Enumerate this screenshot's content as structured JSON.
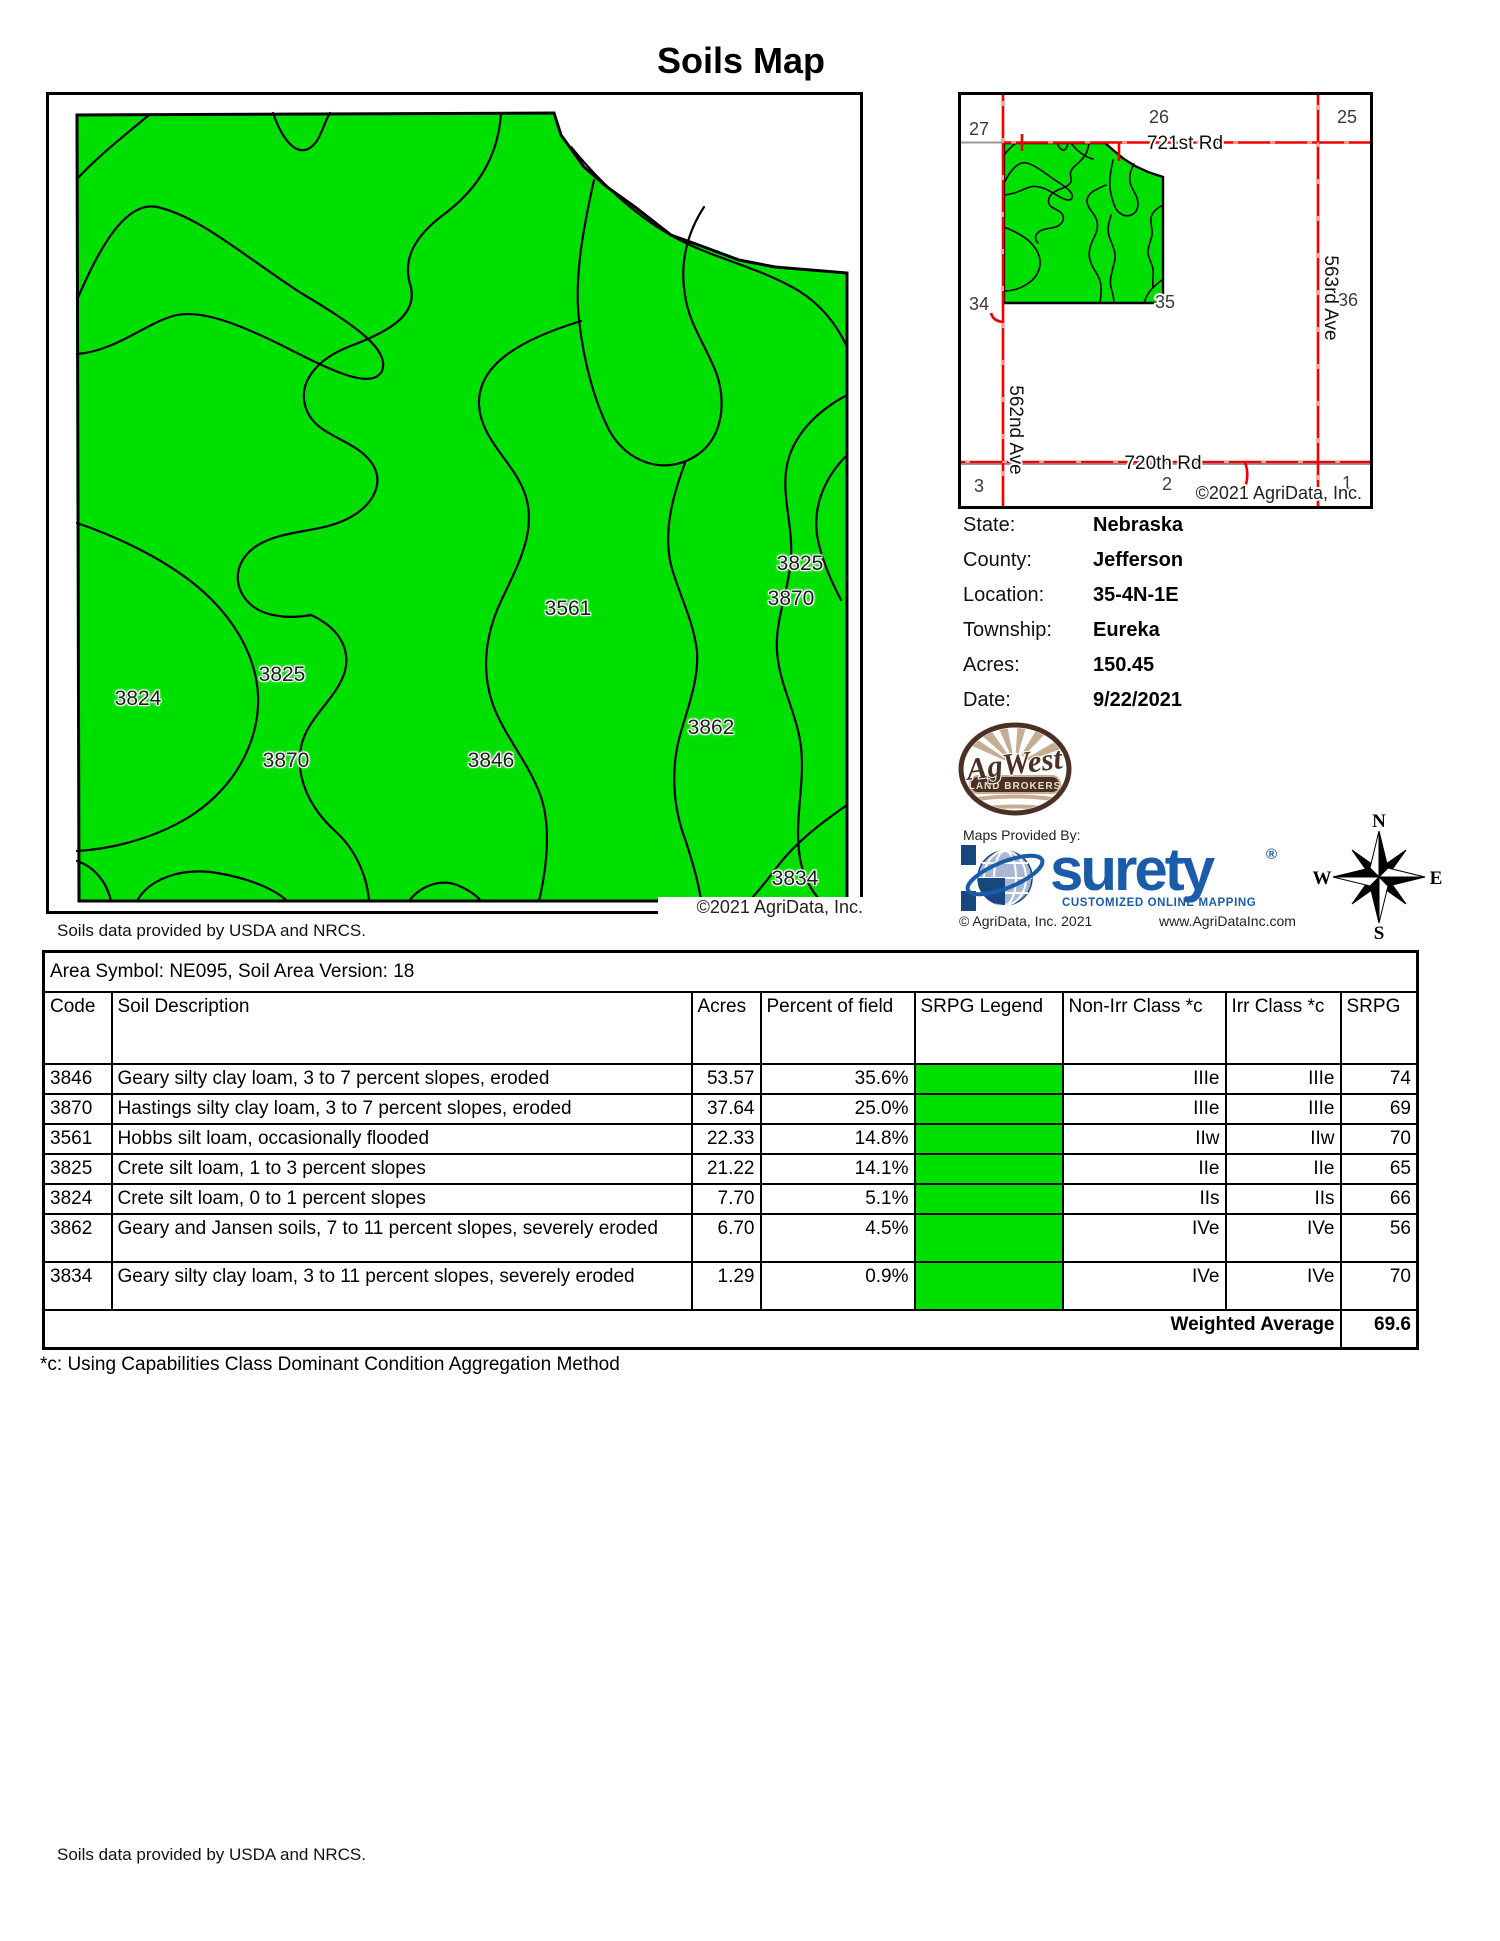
{
  "title": "Soils Map",
  "main_map": {
    "labels": [
      "3825",
      "3870",
      "3561",
      "3825",
      "3824",
      "3862",
      "3870",
      "3846",
      "3834"
    ],
    "copyright": "©2021 AgriData, Inc.",
    "attribution": "Soils data provided by USDA and NRCS."
  },
  "locator": {
    "sections": [
      "27",
      "26",
      "25",
      "34",
      "35",
      "36",
      "3",
      "2",
      "1"
    ],
    "roads": {
      "r721": "721st Rd",
      "r720": "720th Rd",
      "a562": "562nd Ave",
      "a563": "563rd Ave"
    },
    "copyright": "©2021 AgriData, Inc."
  },
  "info": {
    "rows": [
      {
        "label": "State:",
        "value": "Nebraska"
      },
      {
        "label": "County:",
        "value": "Jefferson"
      },
      {
        "label": "Location:",
        "value": "35-4N-1E"
      },
      {
        "label": "Township:",
        "value": "Eureka"
      },
      {
        "label": "Acres:",
        "value": "150.45"
      },
      {
        "label": "Date:",
        "value": "9/22/2021"
      }
    ]
  },
  "logos": {
    "agwest": {
      "name": "AgWest",
      "banner": "LAND BROKERS"
    },
    "surety": {
      "provided_by": "Maps Provided By:",
      "brand": "surety",
      "reg": "®",
      "tagline": "CUSTOMIZED ONLINE MAPPING",
      "copyright": "© AgriData, Inc. 2021",
      "website": "www.AgriDataInc.com"
    }
  },
  "compass": {
    "n": "N",
    "s": "S",
    "e": "E",
    "w": "W"
  },
  "table": {
    "area_symbol": "Area Symbol: NE095, Soil Area Version: 18",
    "headers": [
      "Code",
      "Soil Description",
      "Acres",
      "Percent of field",
      "SRPG Legend",
      "Non-Irr Class *c",
      "Irr Class *c",
      "SRPG"
    ],
    "rows": [
      {
        "code": "3846",
        "description": "Geary silty clay loam, 3 to 7 percent slopes, eroded",
        "acres": "53.57",
        "percent": "35.6%",
        "non_irr": "IIIe",
        "irr": "IIIe",
        "srpg": "74"
      },
      {
        "code": "3870",
        "description": "Hastings silty clay loam, 3 to 7 percent slopes, eroded",
        "acres": "37.64",
        "percent": "25.0%",
        "non_irr": "IIIe",
        "irr": "IIIe",
        "srpg": "69"
      },
      {
        "code": "3561",
        "description": "Hobbs silt loam, occasionally flooded",
        "acres": "22.33",
        "percent": "14.8%",
        "non_irr": "IIw",
        "irr": "IIw",
        "srpg": "70"
      },
      {
        "code": "3825",
        "description": "Crete silt loam, 1 to 3 percent slopes",
        "acres": "21.22",
        "percent": "14.1%",
        "non_irr": "IIe",
        "irr": "IIe",
        "srpg": "65"
      },
      {
        "code": "3824",
        "description": "Crete silt loam, 0 to 1 percent slopes",
        "acres": "7.70",
        "percent": "5.1%",
        "non_irr": "IIs",
        "irr": "IIs",
        "srpg": "66"
      },
      {
        "code": "3862",
        "description": "Geary and Jansen soils, 7 to 11 percent slopes, severely eroded",
        "acres": "6.70",
        "percent": "4.5%",
        "non_irr": "IVe",
        "irr": "IVe",
        "srpg": "56"
      },
      {
        "code": "3834",
        "description": "Geary silty clay loam, 3 to 11 percent slopes, severely eroded",
        "acres": "1.29",
        "percent": "0.9%",
        "non_irr": "IVe",
        "irr": "IVe",
        "srpg": "70"
      }
    ],
    "weighted": {
      "label": "Weighted Average",
      "value": "69.6"
    }
  },
  "footnote": "*c:  Using Capabilities Class Dominant Condition Aggregation Method",
  "bottom_attribution": "Soils data provided by USDA and NRCS.",
  "colors": {
    "map_green": "#00e000",
    "legend_green": "#00e000",
    "road_red": "#f20000",
    "surety_blue": "#1b5caa"
  }
}
